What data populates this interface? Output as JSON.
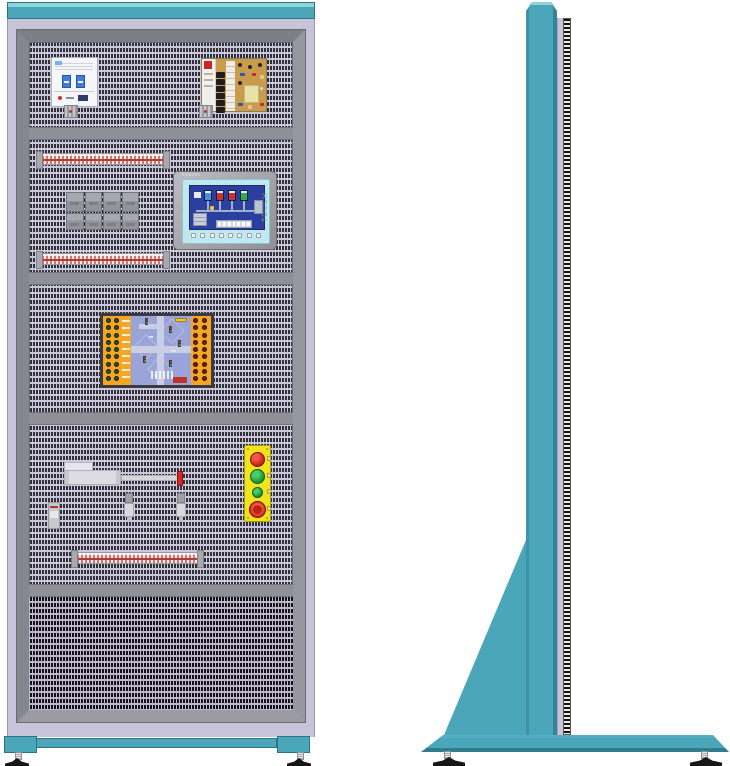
{
  "title": "Electrical training cabinet — front and side views",
  "colors": {
    "teal": "#4BA6B9",
    "teal_light": "#8FD3DD",
    "teal_dark": "#2A7585",
    "lavender": "#C7C4D9",
    "frame_gray": "#8E8E96",
    "panel_light": "#CCC8DC",
    "panel_dash_dark": "#312F38",
    "bottom_panel_dark": "#131316",
    "board_orange": "#F5A623",
    "station_yellow": "#F2E41C",
    "button_red": "#D42A20",
    "button_green": "#1FA23E",
    "screen_blue": "#2B3F9E",
    "hmi_cyan": "#BFE9EF",
    "pcb_gold": "#C89C4C"
  },
  "front_view": {
    "breaker": {
      "poles": 2
    },
    "power_supply": {
      "terminal_count": 6
    },
    "relay_row": {
      "top_modules": 4,
      "bottom_modules": 4
    },
    "hmi": {
      "brand": "SIEMENS",
      "touch_label": "TOUCH",
      "function_key_count": 8,
      "tank_colors": [
        "#4D8FD8",
        "#D03028",
        "#D03028",
        "#2FB043"
      ],
      "pipe_stub_count": 4,
      "conveyor_cell_count": 7
    },
    "plc_board": {
      "left_jacks_per_column": 9,
      "right_jacks_per_column": 9,
      "label_row_count": 9,
      "crosswalk_stripe_count": 6
    },
    "button_station": {
      "buttons": [
        "red",
        "green",
        "green-small",
        "emergency-stop"
      ]
    },
    "terminal_strip_count": 3,
    "sensor_count": 2,
    "feet_count": 2
  },
  "side_view": {
    "feet_count": 2
  }
}
